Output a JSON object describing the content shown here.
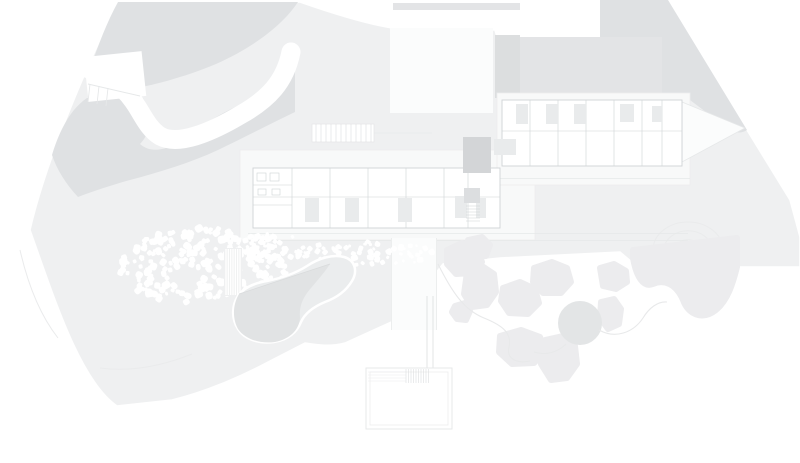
{
  "drawing": {
    "kind": "architectural-site-plan",
    "regions": [
      "hillside-upper-slope",
      "hillside-lower-slope",
      "driveway",
      "auto-court",
      "garage-block",
      "west-wing",
      "east-wing",
      "courtyard-room",
      "gravel-garden",
      "stepped-path",
      "pond",
      "tree-canopies",
      "garden-path",
      "viewing-deck",
      "contour-knoll"
    ]
  },
  "colors": {
    "white": "#ffffff",
    "background": "#ffffff",
    "site_base": "#eff0f1",
    "terrain_dark": "#dfe1e3",
    "terrain_mid": "#e3e4e6",
    "court": "#fbfcfc",
    "garage_block": "#dcdedf",
    "terrace": "#f8f9f9",
    "terrace_edge": "#ededee",
    "wall_line": "#cfd3d5",
    "faint_line": "#e6e8e9",
    "room_dark": "#d3d5d7",
    "room_medium": "#dcdee0",
    "room_light": "#e9ebec",
    "pond_light": "#ebedee",
    "pond_dark": "#e1e3e4",
    "pond_fold": "#d9dbdc",
    "canopy": "#ececee",
    "canopy_dark": "#e3e5e6",
    "pebble": "#ffffff",
    "path_line": "#e8e9ea",
    "contour": "#eaebec",
    "deck_line": "#e7e9ea",
    "hatch": "#dcdedf"
  },
  "decor": {
    "pebble_fields": [
      {
        "name": "gravel-garden-main",
        "cx": 202,
        "cy": 266,
        "rx": 86,
        "ry": 38,
        "count": 250,
        "min": 3.5,
        "max": 8,
        "seed": 7,
        "clip_building": true,
        "hole": {
          "cx": 186,
          "cy": 282,
          "r": 12
        }
      },
      {
        "name": "gravel-garden-arm",
        "cx": 268,
        "cy": 247,
        "rx": 42,
        "ry": 14,
        "count": 70,
        "min": 3,
        "max": 6.5,
        "seed": 3,
        "clip_building": false,
        "hole": null
      },
      {
        "name": "gravel-band-east",
        "cx": 372,
        "cy": 253,
        "rx": 72,
        "ry": 12,
        "count": 80,
        "min": 2.5,
        "max": 6,
        "seed": 11,
        "clip_building": false,
        "hole": null
      }
    ],
    "steps": {
      "x": 224,
      "y": 248,
      "w": 18,
      "h": 48,
      "lines": 7
    },
    "contours": {
      "cx": 688,
      "cy": 250,
      "radii": [
        13,
        24,
        35
      ]
    }
  }
}
